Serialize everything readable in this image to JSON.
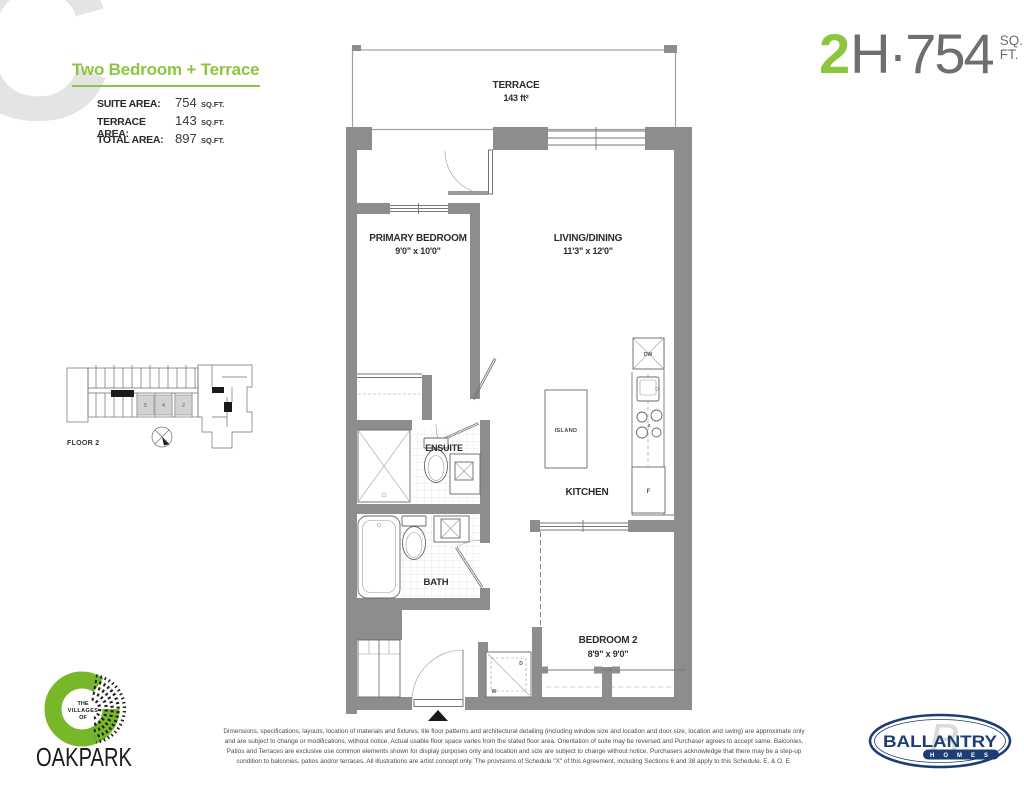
{
  "header": {
    "watermark": "C",
    "plan_title": "Two Bedroom + Terrace",
    "areas": [
      {
        "label": "SUITE AREA:",
        "value": "754",
        "unit": "SQ.FT."
      },
      {
        "label": "TERRACE AREA:",
        "value": "143",
        "unit": "SQ.FT."
      },
      {
        "label": "TOTAL AREA:",
        "value": "897",
        "unit": "SQ.FT."
      }
    ],
    "unit_code": {
      "floor_digit": "2",
      "suffix": "H·754",
      "sq": "SQ.",
      "ft": "FT."
    }
  },
  "floorplan": {
    "terrace_name": "TERRACE",
    "terrace_area": "143 ft²",
    "primary_name": "PRIMARY BEDROOM",
    "primary_dims": "9'0\" x 10'0\"",
    "living_name": "LIVING/DINING",
    "living_dims": "11'3\" x 12'0\"",
    "ensuite_name": "ENSUITE",
    "bath_name": "BATH",
    "kitchen_name": "KITCHEN",
    "island_name": "ISLAND",
    "bedroom2_name": "BEDROOM 2",
    "bedroom2_dims": "8'9\" x 9'0\"",
    "appliances": {
      "dishwasher": "DW",
      "stove": "S",
      "fridge": "F",
      "dryer": "D",
      "washer": "W"
    }
  },
  "keyplan": {
    "label": "FLOOR 2",
    "units": [
      "5",
      "4",
      "2"
    ]
  },
  "footer": {
    "disclaimer": "Dimensions, specifications, layouts, location of materials and fixtures, tile floor patterns and architectural detailing (including window size and location and door size, location and swing) are approximate only and are subject to change or modifications, without notice. Actual usable floor space varies from the stated floor area. Orientation of suite may be reversed and Purchaser agrees to accept same. Balconies, Patios and Terraces are exclusive use common elements shown for display purposes only and location and size are subject to change without notice. Purchasers acknowledge that there may be a step-up condition to balconies, patios and/or terraces. All illustrations are artist concept only. The provisions of Schedule \"X\" of this Agreement, including Sections 6 and 38 apply to this Schedule. E. & O. E.",
    "oakpark": {
      "the": "THE",
      "villages": "VILLAGES",
      "of": "OF",
      "name": "OAKPARK"
    },
    "ballantry": {
      "monogram": "B",
      "name": "BALLANTRY",
      "homes": "HOMES"
    }
  },
  "colors": {
    "green": "#8cc63e",
    "gray_text": "#6d6e71",
    "wall": "#8d8d8d",
    "navy": "#1d3e74"
  }
}
